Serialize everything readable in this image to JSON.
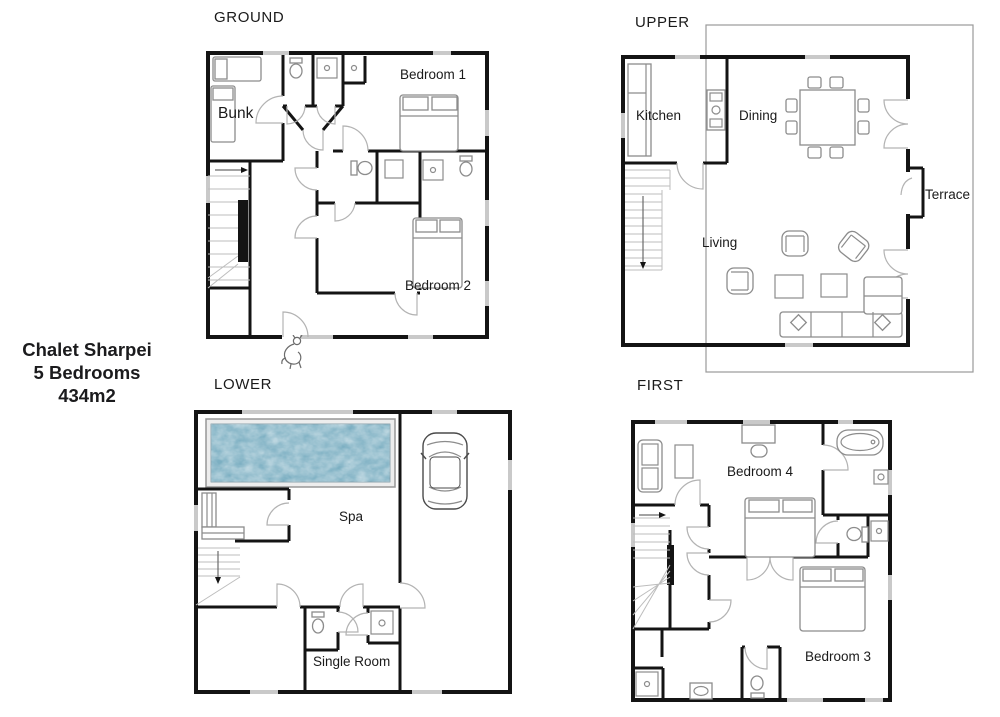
{
  "title": {
    "name": "Chalet Sharpei",
    "bedrooms": "5 Bedrooms",
    "area": "434m2"
  },
  "floors": {
    "ground": {
      "name": "GROUND",
      "bunk": "Bunk",
      "bedroom1": "Bedroom 1",
      "bedroom2": "Bedroom 2"
    },
    "upper": {
      "name": "UPPER",
      "kitchen": "Kitchen",
      "dining": "Dining",
      "living": "Living",
      "terrace": "Terrace"
    },
    "lower": {
      "name": "LOWER",
      "spa": "Spa",
      "single_room": "Single Room"
    },
    "first": {
      "name": "FIRST",
      "bedroom4": "Bedroom 4",
      "bedroom3": "Bedroom 3"
    }
  },
  "colors": {
    "wall": "#141414",
    "furniture": "#8c8c8c",
    "door_arc": "#b3b3b3",
    "window": "#c9c9c9",
    "pool_water": "#7cafc2",
    "pool_frame": "#ededed",
    "text": "#1a1a1a"
  }
}
